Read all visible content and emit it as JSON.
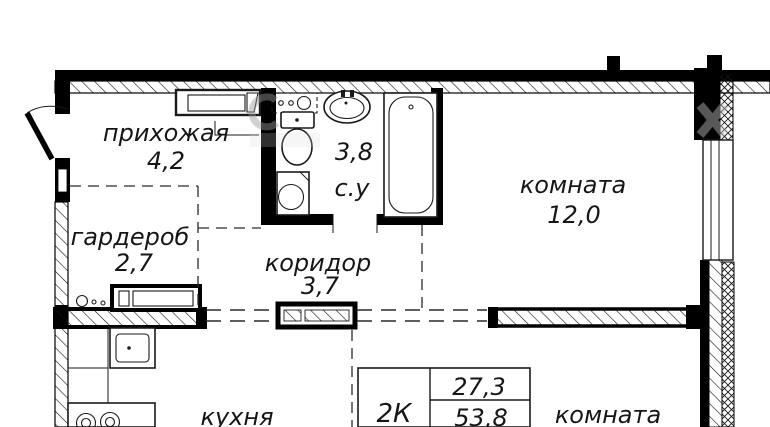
{
  "plan": {
    "rooms": [
      {
        "id": "hallway",
        "name": "прихожая",
        "area": "4,2"
      },
      {
        "id": "bathroom",
        "name": "с.у",
        "area": "3,8"
      },
      {
        "id": "room-1",
        "name": "комната",
        "area": "12,0"
      },
      {
        "id": "wardrobe",
        "name": "гардероб",
        "area": "2,7"
      },
      {
        "id": "corridor",
        "name": "коридор",
        "area": "3,7"
      },
      {
        "id": "kitchen",
        "name": "кухня",
        "area": ""
      },
      {
        "id": "room-2",
        "name": "комната",
        "area": ""
      }
    ],
    "info_table": {
      "apartment_type": "2К",
      "value_top": "27,3",
      "value_bottom": "53,8"
    },
    "colors": {
      "wall": "#000000",
      "background": "#ffffff",
      "text": "#161616"
    }
  }
}
